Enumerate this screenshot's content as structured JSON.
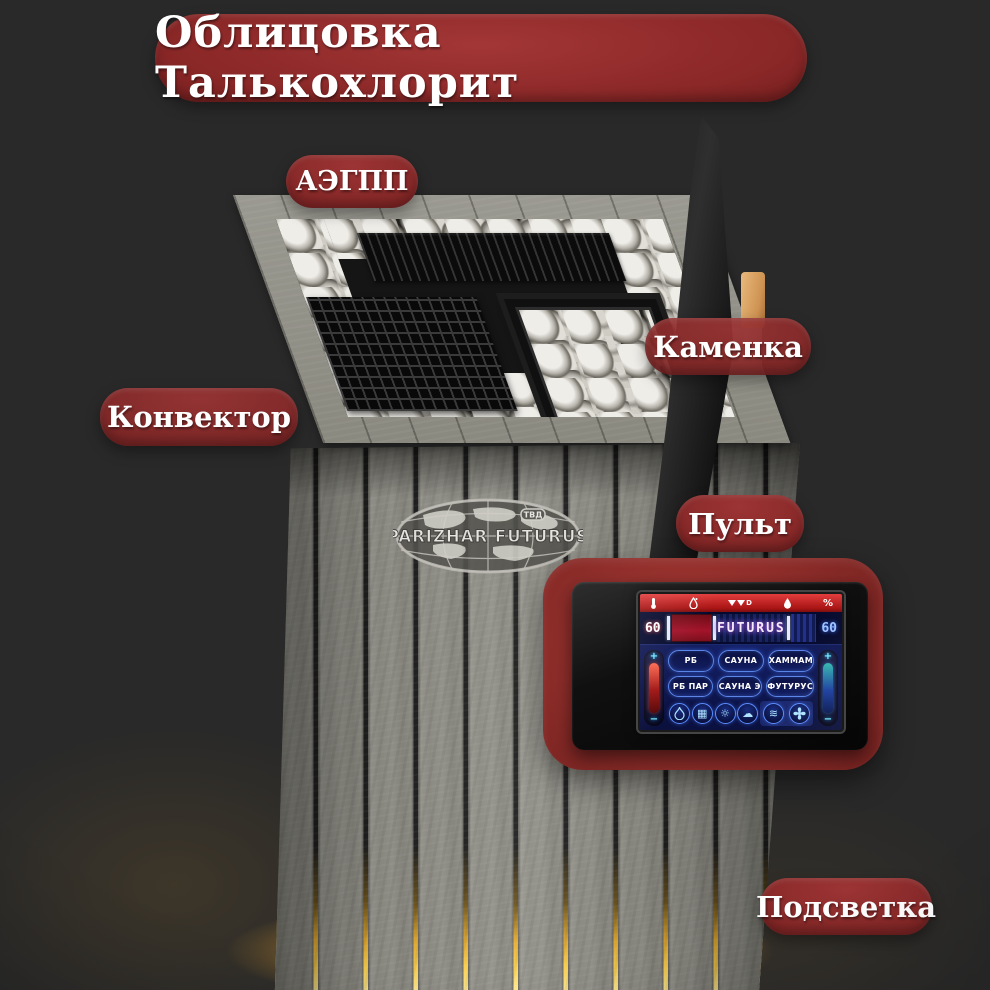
{
  "title": "Облицовка Талькохлорит",
  "labels": {
    "aegpp": "АЭГПП",
    "kamenka": "Каменка",
    "konvektor": "Конвектор",
    "pult": "Пульт",
    "podsvetka": "Подсветка"
  },
  "logo": {
    "brand": "PARIZHAR FUTURUS",
    "badge": "ТВД"
  },
  "remote": {
    "statusbar": {
      "brand": "D",
      "percent": "%"
    },
    "display": {
      "left_temp": "60",
      "right_value": "60",
      "model": "FUTURUS"
    },
    "modes": [
      "РБ",
      "САУНА",
      "ХАММАМ",
      "РБ ПАР",
      "САУНА Э",
      "ФУТУРУС"
    ],
    "slider": {
      "plus": "+",
      "minus": "−"
    },
    "glyphs": {
      "grid": "▦",
      "light": "☼",
      "cloud": "☁",
      "waves": "≋"
    }
  },
  "colors": {
    "label_red": "#8c2727",
    "glow_yellow": "#ffcf4a",
    "screen_blue": "#101a56",
    "statusbar_red": "#c01f1f"
  }
}
